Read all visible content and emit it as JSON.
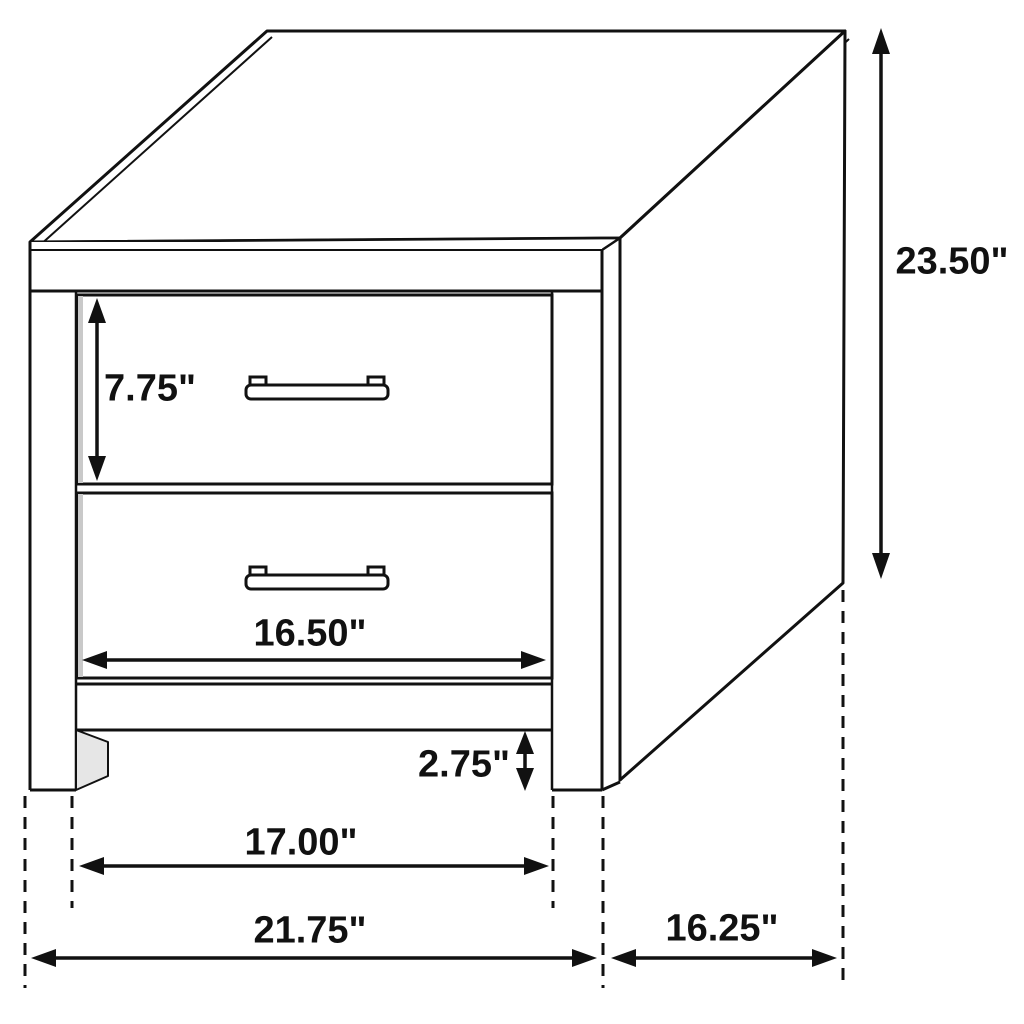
{
  "diagram": {
    "subject": "two-drawer nightstand isometric line drawing with dimension callouts",
    "unit": "inches",
    "colors": {
      "line": "#111111",
      "background": "#ffffff",
      "shadow_light": "#e6e6e6",
      "shadow_strip": "#c9c9c9"
    },
    "labels": {
      "drawer_opening_height": "7.75\"",
      "overall_height": "23.50\"",
      "drawer_front_width": "16.50\"",
      "base_clearance_height": "2.75\"",
      "width_between_legs": "17.00\"",
      "overall_width": "21.75\"",
      "overall_depth": "16.25\""
    },
    "dimension_list": [
      {
        "name": "drawer opening height",
        "value": "7.75\""
      },
      {
        "name": "overall height",
        "value": "23.50\""
      },
      {
        "name": "drawer front width",
        "value": "16.50\""
      },
      {
        "name": "base clearance height",
        "value": "2.75\""
      },
      {
        "name": "width between legs",
        "value": "17.00\""
      },
      {
        "name": "overall width",
        "value": "21.75\""
      },
      {
        "name": "overall depth",
        "value": "16.25\""
      }
    ]
  }
}
